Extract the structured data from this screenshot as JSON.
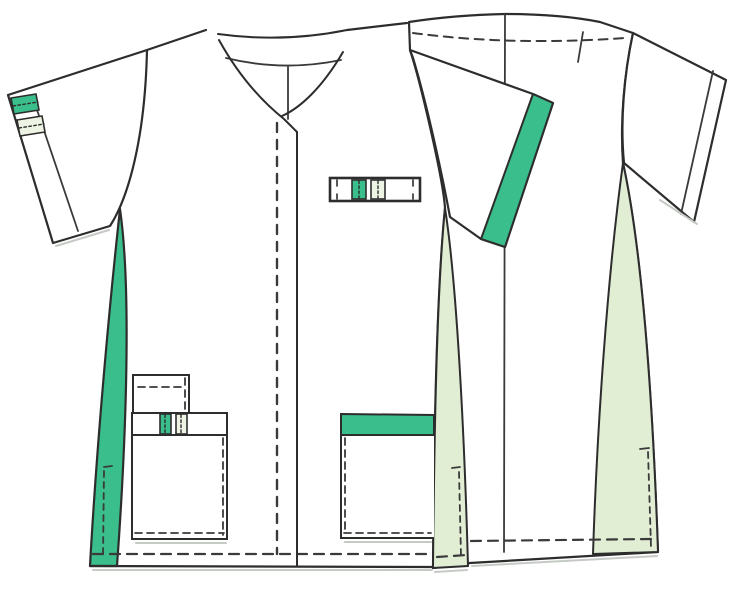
{
  "canvas": {
    "width": 750,
    "height": 590,
    "background": "#ffffff"
  },
  "figure": {
    "type": "garment-technical-flat",
    "garment": "v-neck-scrub-tunic",
    "views": [
      "front",
      "back"
    ]
  },
  "colors": {
    "outline": "#2d2d2d",
    "line_fine": "#3a3a3a",
    "accent_green": "#3abe8b",
    "pale_green": "#e2eed4",
    "pale_tab": "#eef4e3",
    "white": "#ffffff",
    "shadow": "#c5cac4"
  }
}
